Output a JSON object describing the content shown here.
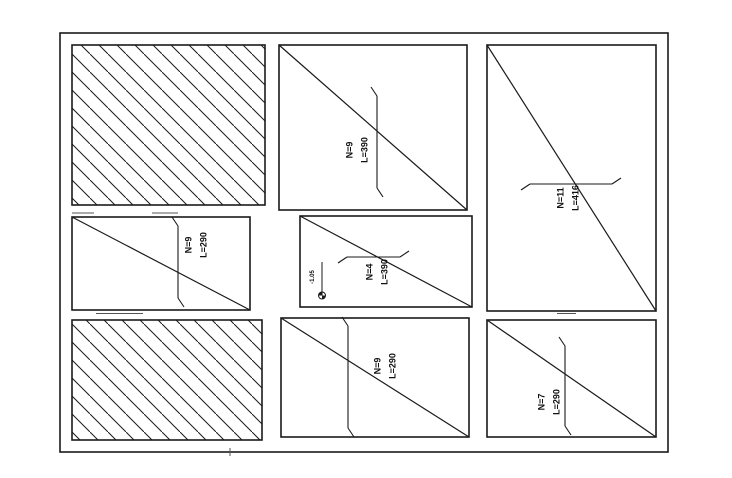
{
  "meta": {
    "ink": "#1a1a1a",
    "background": "#ffffff",
    "artifact_color": "#555555"
  },
  "border": {
    "x": 60,
    "y": 33,
    "w": 608,
    "h": 419
  },
  "panels": [
    {
      "name": "panel-top-left",
      "x": 72,
      "y": 45,
      "w": 193,
      "h": 160,
      "hatched": true
    },
    {
      "name": "panel-top-middle",
      "x": 279,
      "y": 45,
      "w": 188,
      "h": 165,
      "diagonal": true,
      "marker": {
        "type": "v",
        "x": 377,
        "y1": 96,
        "y2": 188
      },
      "label": {
        "line1": "N=9",
        "line2": "L=390",
        "cx": 357,
        "cy": 150
      }
    },
    {
      "name": "panel-right-tall",
      "x": 487,
      "y": 45,
      "w": 169,
      "h": 266,
      "diagonal": true,
      "marker": {
        "type": "h",
        "y": 184,
        "x1": 530,
        "x2": 612
      },
      "label": {
        "line1": "N=11",
        "line2": "L=416",
        "cx": 568,
        "cy": 198
      }
    },
    {
      "name": "panel-middle-left",
      "x": 72,
      "y": 217,
      "w": 178,
      "h": 93,
      "diagonal": true,
      "marker": {
        "type": "v",
        "x": 178,
        "y1": 226,
        "y2": 298
      },
      "label": {
        "line1": "N=9",
        "line2": "L=290",
        "cx": 196,
        "cy": 245
      }
    },
    {
      "name": "panel-middle-center",
      "x": 300,
      "y": 216,
      "w": 172,
      "h": 91,
      "diagonal": true,
      "marker": {
        "type": "h",
        "y": 257,
        "x1": 347,
        "x2": 400
      },
      "label": {
        "line1": "N=4",
        "line2": "L=390",
        "cx": 377,
        "cy": 272
      },
      "elevation": {
        "x": 322,
        "y1": 262,
        "y2": 292,
        "r": 3.5,
        "text": "-1.05",
        "tx": 313,
        "ty": 277
      }
    },
    {
      "name": "panel-bottom-left",
      "x": 72,
      "y": 320,
      "w": 190,
      "h": 120,
      "hatched": true
    },
    {
      "name": "panel-bottom-middle",
      "x": 281,
      "y": 318,
      "w": 188,
      "h": 119,
      "diagonal": true,
      "marker": {
        "type": "v",
        "x": 348,
        "y1": 326,
        "y2": 428
      },
      "label": {
        "line1": "N=9",
        "line2": "L=290",
        "cx": 385,
        "cy": 366
      }
    },
    {
      "name": "panel-bottom-right",
      "x": 487,
      "y": 320,
      "w": 169,
      "h": 117,
      "diagonal": true,
      "marker": {
        "type": "v",
        "x": 565,
        "y1": 346,
        "y2": 426
      },
      "label": {
        "line1": "N=7",
        "line2": "L=290",
        "cx": 549,
        "cy": 402
      }
    }
  ],
  "artifacts": [
    {
      "x1": 72,
      "y1": 213,
      "x2": 94,
      "y2": 213
    },
    {
      "x1": 152,
      "y1": 213,
      "x2": 178,
      "y2": 213
    },
    {
      "x1": 96,
      "y1": 313.5,
      "x2": 143,
      "y2": 313.5
    },
    {
      "x1": 557,
      "y1": 313.5,
      "x2": 576,
      "y2": 313.5
    },
    {
      "x1": 230,
      "y1": 448,
      "x2": 230,
      "y2": 456
    }
  ]
}
